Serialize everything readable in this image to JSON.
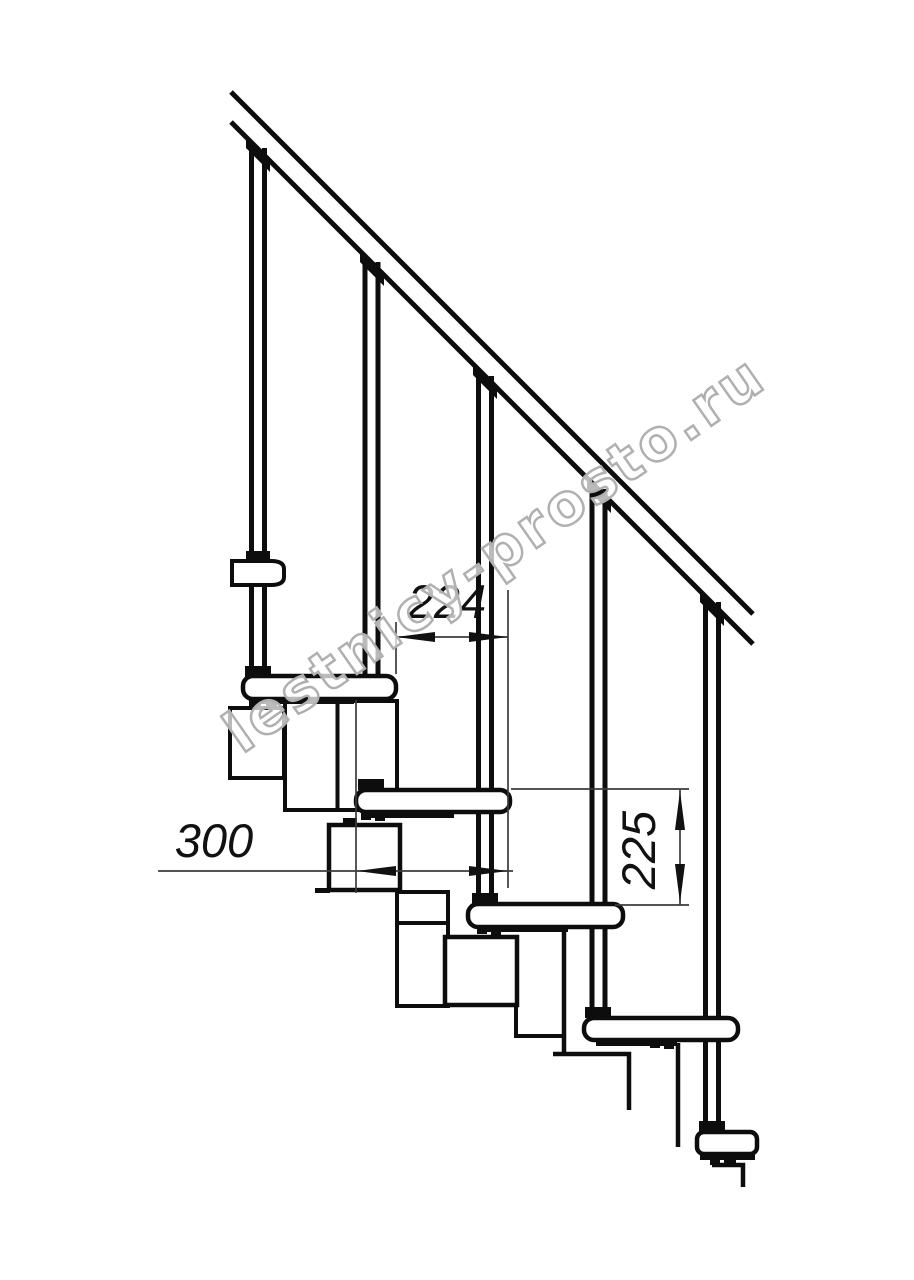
{
  "drawing": {
    "watermark_text": "lestnicy-prosto.ru",
    "dimensions": {
      "tread_pitch_label": "224",
      "tread_length_label": "300",
      "rise_label": "225"
    },
    "colors": {
      "line": "#0d0d0d",
      "dimension_line": "#3c3c3c",
      "watermark_outline": "#b0b0b0",
      "background": "#ffffff"
    }
  }
}
